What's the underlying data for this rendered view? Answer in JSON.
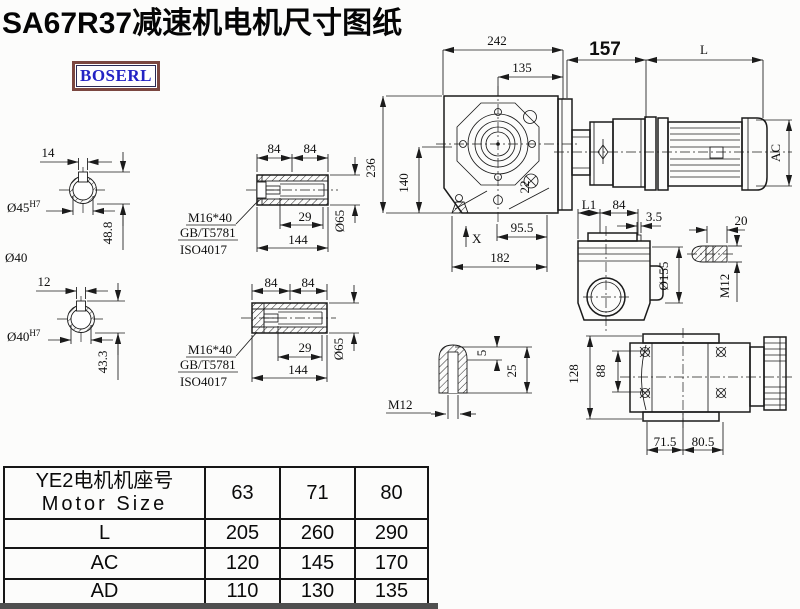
{
  "title": "SA67R37减速机电机尺寸图纸",
  "logo": {
    "text": "BOSERL"
  },
  "drawing": {
    "shaft1": {
      "key_width": "14",
      "bore": "Ø45",
      "tol": "H7",
      "depth": "48.8",
      "note": "Ø40"
    },
    "shaft2": {
      "key_width": "12",
      "bore": "Ø40",
      "tol": "H7",
      "depth": "43.3"
    },
    "hollow1": {
      "len_a": "84",
      "len_b": "84",
      "bolt": "M16*40",
      "std1": "GB/T5781",
      "std2": "ISO4017",
      "inner": "29",
      "total": "144",
      "dia": "Ø65"
    },
    "hollow2": {
      "len_a": "84",
      "len_b": "84",
      "bolt": "M16*40",
      "std1": "GB/T5781",
      "std2": "ISO4017",
      "inner": "29",
      "total": "144",
      "dia": "Ø65"
    },
    "main": {
      "top_width": "242",
      "face_width": "135",
      "mid_len": "157",
      "motor_len": "L",
      "height": "236",
      "center_height": "140",
      "offset": "22",
      "foot_a": "95.5",
      "foot_b": "182",
      "mark": "X",
      "motor_dia": "AC"
    },
    "side": {
      "len1": "L1",
      "len2": "84",
      "step": "3.5",
      "flange_dia": "Ø155",
      "plug_len": "20",
      "plug_thread": "M12"
    },
    "shaft_end": {
      "depth": "5",
      "length": "25",
      "thread": "M12"
    },
    "bottom": {
      "height": "128",
      "bolt_span": "88",
      "foot_a": "71.5",
      "foot_b": "80.5"
    }
  },
  "table": {
    "header_cn": "YE2电机机座号",
    "header_en": "Motor Size",
    "sizes": [
      "63",
      "71",
      "80"
    ],
    "rows": [
      {
        "label": "L",
        "values": [
          "205",
          "260",
          "290"
        ]
      },
      {
        "label": "AC",
        "values": [
          "120",
          "145",
          "170"
        ]
      },
      {
        "label": "AD",
        "values": [
          "110",
          "130",
          "135"
        ]
      }
    ]
  }
}
